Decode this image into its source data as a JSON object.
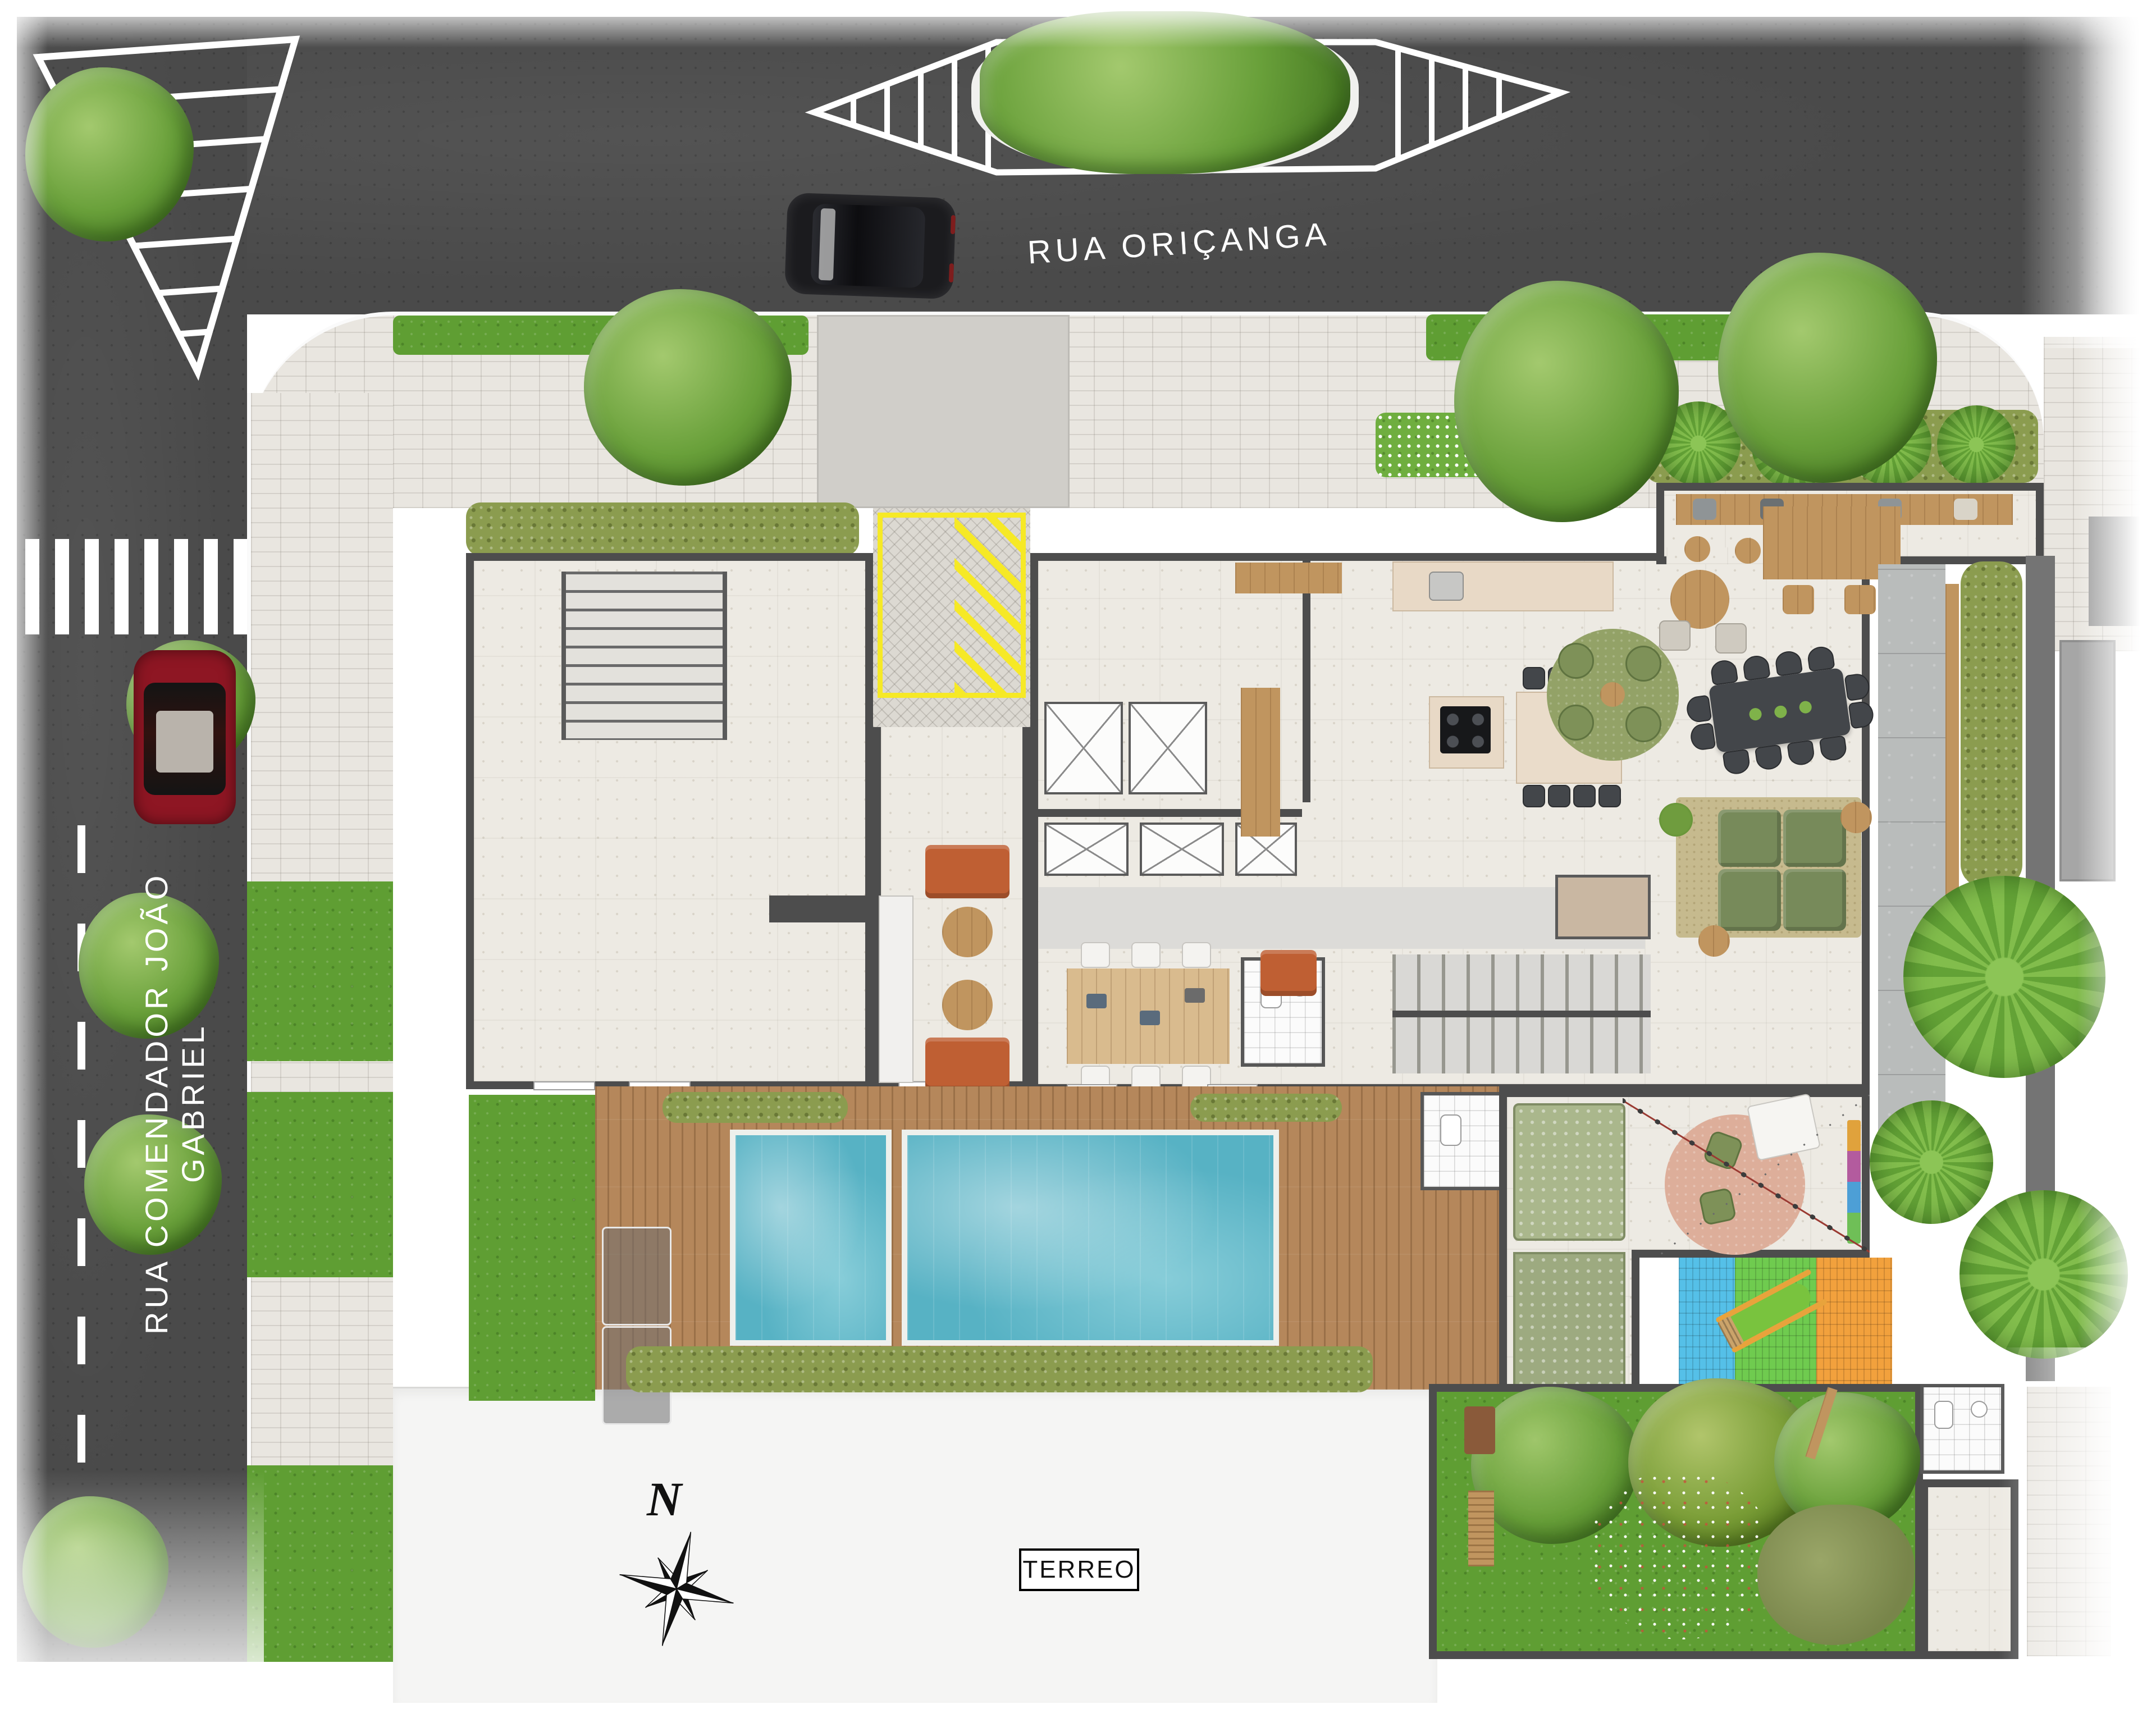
{
  "streets": {
    "top": {
      "name": "RUA ORIÇANGA"
    },
    "left": {
      "name": "RUA COMENDADOR JOÃO GABRIEL"
    }
  },
  "plan": {
    "level_label": "TERREO"
  },
  "compass": {
    "north_label": "N"
  },
  "colors": {
    "asphalt": "#4a4a4a",
    "sidewalk": "#e9e6e0",
    "terrazzo": "#edeae3",
    "wall": "#4d4d4d",
    "court_paver": "#dcd9d2",
    "curb": "#fafafa",
    "yellow": "#f6e926",
    "wood": "#c0955f",
    "deck": "#b5875b",
    "pool": "#57b2c4",
    "lawn": "#5f9e33",
    "hedge_olive": "#8b9c4f",
    "tree": "#69a03a",
    "palm": "#63a236",
    "flower_bed": "#6fae3f",
    "play_blue": "#55c0e8",
    "play_green": "#6fcb4f",
    "play_orange": "#f2a13d",
    "sofa_orange": "#bf5f33",
    "sofa_green": "#778a5a",
    "rug_green": "#93a267",
    "rug_beige": "#c6ba8e",
    "rug_pink": "#ddae9a",
    "table_dark": "#43464a",
    "kids_mat": "#9daa80",
    "car_red": "#8e1623",
    "car_black": "#1b1b1e",
    "gray_band": "#747474",
    "gray_plaza": "#b9bcbb",
    "ramp_gray": "#a6a6a6"
  }
}
